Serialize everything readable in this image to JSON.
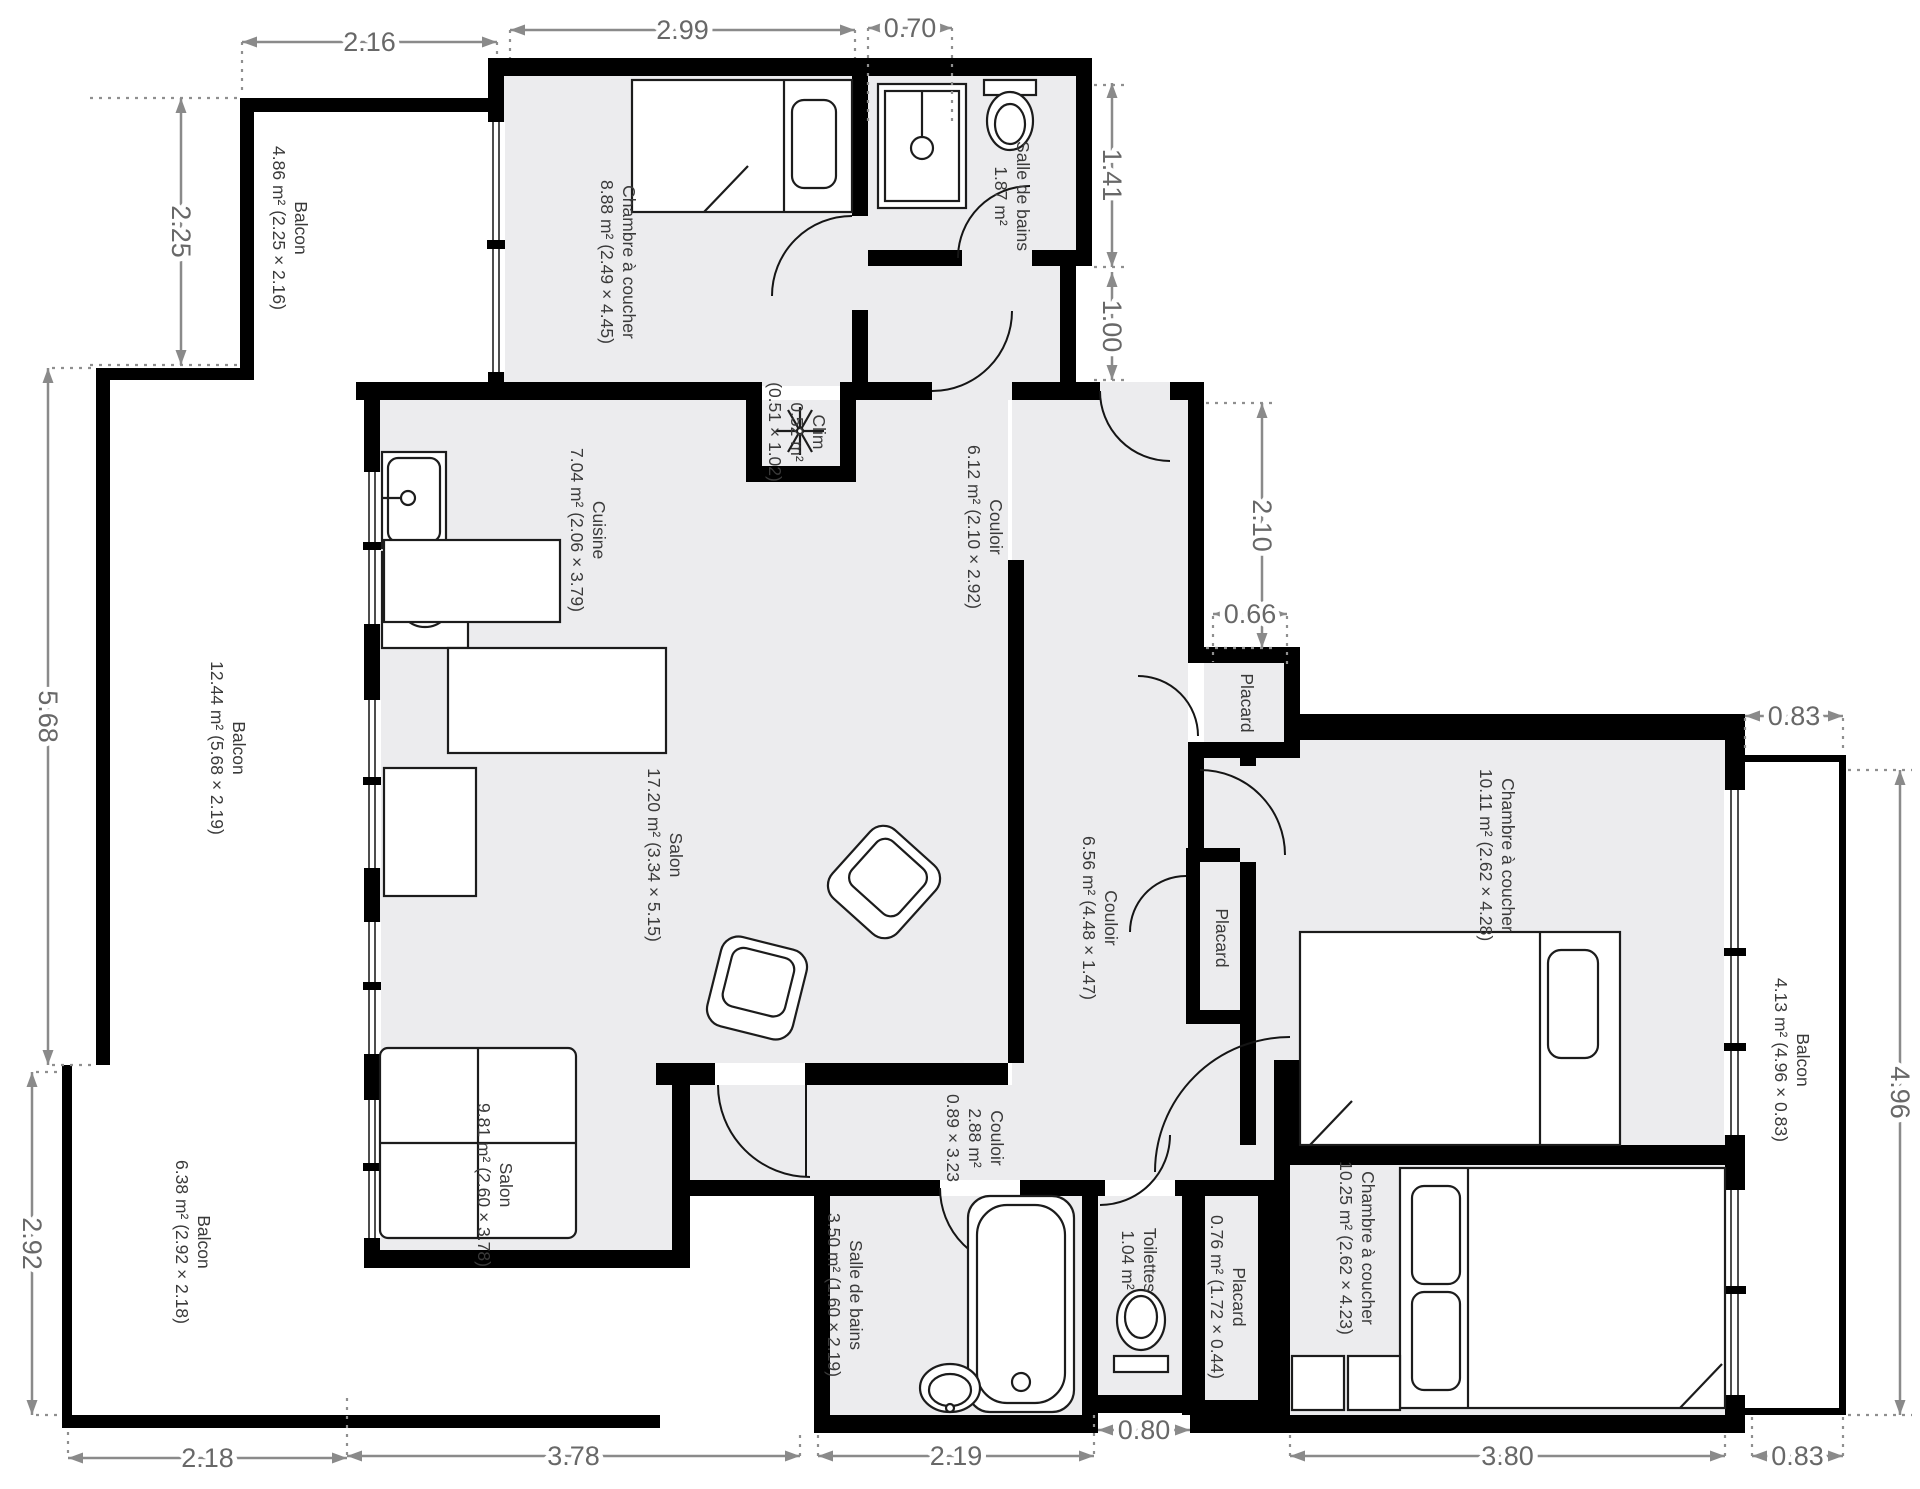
{
  "plan": {
    "canvas": {
      "width": 1920,
      "height": 1489
    },
    "colors": {
      "wall": "#000000",
      "floor": "#ececee",
      "dimension": "#8a8a8a",
      "label": "#3a3a3a"
    },
    "rooms": [
      {
        "id": "balcon-haut-gauche",
        "lines": [
          "Balcon",
          "4.86 m² (2.25 × 2.16)"
        ],
        "x": 290,
        "y": 228
      },
      {
        "id": "chambre-haut",
        "lines": [
          "Chambre à coucher",
          "8.88 m² (2.49 × 4.45)"
        ],
        "x": 618,
        "y": 262
      },
      {
        "id": "salle-de-bains-haut",
        "lines": [
          "Salle de bains",
          "1.87 m²"
        ],
        "x": 1012,
        "y": 196
      },
      {
        "id": "clim",
        "lines": [
          "Clim",
          "0.52 m²",
          "(0.51 × 1.02)"
        ],
        "x": 797,
        "y": 432
      },
      {
        "id": "cuisine",
        "lines": [
          "Cuisine",
          "7.04 m² (2.06 × 3.79)"
        ],
        "x": 588,
        "y": 530
      },
      {
        "id": "couloir-haut",
        "lines": [
          "Couloir",
          "6.12 m² (2.10 × 2.92)"
        ],
        "x": 985,
        "y": 527
      },
      {
        "id": "balcon-gauche",
        "lines": [
          "Balcon",
          "12.44 m² (5.68 × 2.19)"
        ],
        "x": 228,
        "y": 748
      },
      {
        "id": "salon-grand",
        "lines": [
          "Salon",
          "17.20 m² (3.34 × 5.15)"
        ],
        "x": 665,
        "y": 855
      },
      {
        "id": "couloir-milieu",
        "lines": [
          "Couloir",
          "6.56 m² (4.48 × 1.47)"
        ],
        "x": 1100,
        "y": 918
      },
      {
        "id": "placard-haut",
        "lines": [
          "Placard"
        ],
        "x": 1247,
        "y": 703
      },
      {
        "id": "placard-milieu",
        "lines": [
          "Placard"
        ],
        "x": 1222,
        "y": 938
      },
      {
        "id": "chambre-droite",
        "lines": [
          "Chambre à coucher",
          "10.11 m² (2.62 × 4.28)"
        ],
        "x": 1497,
        "y": 855
      },
      {
        "id": "balcon-droit",
        "lines": [
          "Balcon",
          "4.13 m² (4.96 × 0.83)"
        ],
        "x": 1792,
        "y": 1060
      },
      {
        "id": "salon-petit",
        "lines": [
          "Salon",
          "9.81 m² (2.60 × 3.78)"
        ],
        "x": 495,
        "y": 1185
      },
      {
        "id": "balcon-bas",
        "lines": [
          "Balcon",
          "6.38 m² (2.92 × 2.18)"
        ],
        "x": 193,
        "y": 1242
      },
      {
        "id": "couloir-bas",
        "lines": [
          "Couloir",
          "2.88 m²",
          "0.89 × 3.23"
        ],
        "x": 975,
        "y": 1138
      },
      {
        "id": "salle-de-bains-bas",
        "lines": [
          "Salle de bains",
          "3.50 m² (1.60 × 2.19)"
        ],
        "x": 845,
        "y": 1295
      },
      {
        "id": "toilettes",
        "lines": [
          "Toilettes",
          "1.04 m²"
        ],
        "x": 1139,
        "y": 1260
      },
      {
        "id": "placard-bas",
        "lines": [
          "Placard",
          "0.76 m² (1.72 × 0.44)"
        ],
        "x": 1228,
        "y": 1297
      },
      {
        "id": "chambre-bas",
        "lines": [
          "Chambre à coucher",
          "10.25 m² (2.62 × 4.23)"
        ],
        "x": 1357,
        "y": 1248
      }
    ],
    "dimensions": [
      {
        "value": "2.16",
        "orient": "h",
        "x1": 242,
        "x2": 497,
        "y": 42
      },
      {
        "value": "2.99",
        "orient": "h",
        "x1": 510,
        "x2": 855,
        "y": 30
      },
      {
        "value": "0.70",
        "orient": "h",
        "x1": 868,
        "x2": 952,
        "y": 28
      },
      {
        "value": "2.25",
        "orient": "v",
        "y1": 98,
        "y2": 365,
        "x": 181
      },
      {
        "value": "5.68",
        "orient": "v",
        "y1": 368,
        "y2": 1065,
        "x": 48
      },
      {
        "value": "2.92",
        "orient": "v",
        "y1": 1072,
        "y2": 1415,
        "x": 32
      },
      {
        "value": "1.41",
        "orient": "v",
        "y1": 83,
        "y2": 267,
        "x": 1112
      },
      {
        "value": "1.00",
        "orient": "v",
        "y1": 272,
        "y2": 380,
        "x": 1112
      },
      {
        "value": "2.10",
        "orient": "v",
        "y1": 403,
        "y2": 648,
        "x": 1262
      },
      {
        "value": "0.66",
        "orient": "h",
        "x1": 1213,
        "x2": 1287,
        "y": 614
      },
      {
        "value": "0.83",
        "orient": "h",
        "x1": 1745,
        "x2": 1843,
        "y": 716
      },
      {
        "value": "4.96",
        "orient": "v",
        "y1": 770,
        "y2": 1415,
        "x": 1900
      },
      {
        "value": "2.18",
        "orient": "h",
        "x1": 68,
        "x2": 347,
        "y": 1458
      },
      {
        "value": "3.78",
        "orient": "h",
        "x1": 347,
        "x2": 800,
        "y": 1456
      },
      {
        "value": "2.19",
        "orient": "h",
        "x1": 818,
        "x2": 1094,
        "y": 1456
      },
      {
        "value": "0.80",
        "orient": "h",
        "x1": 1098,
        "x2": 1190,
        "y": 1430
      },
      {
        "value": "3.80",
        "orient": "h",
        "x1": 1290,
        "x2": 1725,
        "y": 1456
      },
      {
        "value": "0.83",
        "orient": "h",
        "x1": 1752,
        "x2": 1843,
        "y": 1456
      }
    ]
  }
}
